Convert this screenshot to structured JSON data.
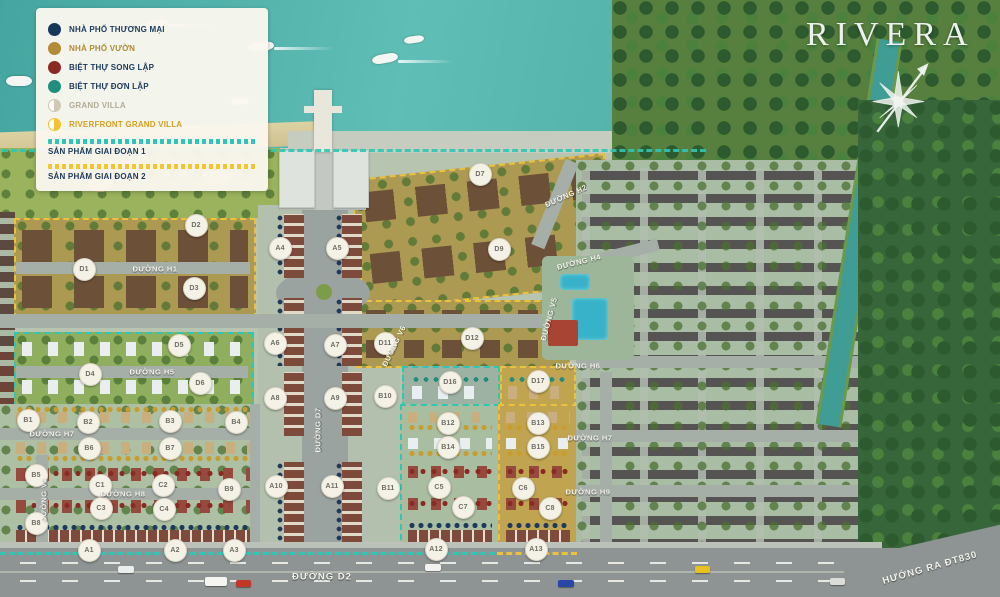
{
  "title": "RIVERA",
  "legend": {
    "items": [
      {
        "label": "NHÀ PHỐ THƯƠNG MẠI",
        "color": "#17375c",
        "text_color": "#1b3a5c",
        "style": "solid"
      },
      {
        "label": "NHÀ PHỐ VƯỜN",
        "color": "#b38a35",
        "text_color": "#b38a35",
        "style": "solid"
      },
      {
        "label": "BIỆT THỰ SONG LẬP",
        "color": "#8a2a22",
        "text_color": "#1b3a5c",
        "style": "solid"
      },
      {
        "label": "BIỆT THỰ ĐƠN LẬP",
        "color": "#1f8e7e",
        "text_color": "#1b3a5c",
        "style": "solid"
      },
      {
        "label": "GRAND VILLA",
        "color": "#cfc8b2",
        "text_color": "#b3ac97",
        "style": "half"
      },
      {
        "label": "RIVERFRONT GRAND VILLA",
        "color": "#f2c230",
        "text_color": "#d4a020",
        "style": "half"
      }
    ],
    "phases": [
      {
        "label": "SẢN PHẨM GIAI ĐOẠN 1",
        "color": "#2fc7b4"
      },
      {
        "label": "SẢN PHẨM GIAI ĐOẠN 2",
        "color": "#f2c431"
      }
    ]
  },
  "map": {
    "blocks": [
      {
        "label": "D1",
        "x": 83,
        "y": 268
      },
      {
        "label": "D2",
        "x": 195,
        "y": 224
      },
      {
        "label": "D3",
        "x": 193,
        "y": 287
      },
      {
        "label": "D4",
        "x": 89,
        "y": 373
      },
      {
        "label": "D5",
        "x": 178,
        "y": 344
      },
      {
        "label": "D6",
        "x": 199,
        "y": 382
      },
      {
        "label": "D7",
        "x": 479,
        "y": 173
      },
      {
        "label": "D9",
        "x": 498,
        "y": 248
      },
      {
        "label": "D11",
        "x": 384,
        "y": 342
      },
      {
        "label": "D12",
        "x": 471,
        "y": 337
      },
      {
        "label": "D16",
        "x": 449,
        "y": 381
      },
      {
        "label": "D17",
        "x": 537,
        "y": 380
      },
      {
        "label": "A1",
        "x": 88,
        "y": 549
      },
      {
        "label": "A2",
        "x": 174,
        "y": 549
      },
      {
        "label": "A3",
        "x": 233,
        "y": 549
      },
      {
        "label": "A4",
        "x": 279,
        "y": 247
      },
      {
        "label": "A5",
        "x": 336,
        "y": 247
      },
      {
        "label": "A6",
        "x": 274,
        "y": 342
      },
      {
        "label": "A7",
        "x": 334,
        "y": 344
      },
      {
        "label": "A8",
        "x": 274,
        "y": 397
      },
      {
        "label": "A9",
        "x": 334,
        "y": 397
      },
      {
        "label": "A10",
        "x": 275,
        "y": 485
      },
      {
        "label": "A11",
        "x": 331,
        "y": 485
      },
      {
        "label": "A12",
        "x": 435,
        "y": 548
      },
      {
        "label": "A13",
        "x": 535,
        "y": 548
      },
      {
        "label": "B1",
        "x": 27,
        "y": 419
      },
      {
        "label": "B2",
        "x": 87,
        "y": 421
      },
      {
        "label": "B3",
        "x": 169,
        "y": 420
      },
      {
        "label": "B4",
        "x": 235,
        "y": 421
      },
      {
        "label": "B5",
        "x": 35,
        "y": 474
      },
      {
        "label": "B6",
        "x": 88,
        "y": 447
      },
      {
        "label": "B7",
        "x": 169,
        "y": 447
      },
      {
        "label": "B8",
        "x": 35,
        "y": 522
      },
      {
        "label": "B9",
        "x": 228,
        "y": 488
      },
      {
        "label": "B10",
        "x": 384,
        "y": 395
      },
      {
        "label": "B11",
        "x": 387,
        "y": 487
      },
      {
        "label": "B12",
        "x": 447,
        "y": 422
      },
      {
        "label": "B13",
        "x": 537,
        "y": 422
      },
      {
        "label": "B14",
        "x": 447,
        "y": 446
      },
      {
        "label": "B15",
        "x": 537,
        "y": 446
      },
      {
        "label": "C1",
        "x": 99,
        "y": 484
      },
      {
        "label": "C2",
        "x": 162,
        "y": 484
      },
      {
        "label": "C3",
        "x": 100,
        "y": 507
      },
      {
        "label": "C4",
        "x": 163,
        "y": 508
      },
      {
        "label": "C5",
        "x": 438,
        "y": 486
      },
      {
        "label": "C6",
        "x": 522,
        "y": 487
      },
      {
        "label": "C7",
        "x": 462,
        "y": 506
      },
      {
        "label": "C8",
        "x": 549,
        "y": 507
      }
    ],
    "roads": [
      {
        "name": "ĐƯỜNG H1",
        "x": 155,
        "y": 269,
        "angle": 0
      },
      {
        "name": "ĐƯỜNG H5",
        "x": 152,
        "y": 372,
        "angle": 0
      },
      {
        "name": "ĐƯỜNG H7",
        "x": 52,
        "y": 434,
        "angle": 0
      },
      {
        "name": "ĐƯỜNG H8",
        "x": 123,
        "y": 494,
        "angle": 0
      },
      {
        "name": "ĐƯỜNG V1",
        "x": 44,
        "y": 500,
        "angle": -90
      },
      {
        "name": "ĐƯỜNG D7",
        "x": 318,
        "y": 430,
        "angle": -90
      },
      {
        "name": "ĐƯỜNG D2",
        "x": 322,
        "y": 577,
        "angle": 0,
        "big": true
      },
      {
        "name": "ĐƯỜNG H2",
        "x": 566,
        "y": 196,
        "angle": -24
      },
      {
        "name": "ĐƯỜNG H4",
        "x": 579,
        "y": 262,
        "angle": -14
      },
      {
        "name": "ĐƯỜNG V5",
        "x": 549,
        "y": 319,
        "angle": -75
      },
      {
        "name": "ĐƯỜNG V6",
        "x": 394,
        "y": 346,
        "angle": -64
      },
      {
        "name": "ĐƯỜNG H6",
        "x": 578,
        "y": 366,
        "angle": 0
      },
      {
        "name": "ĐƯỜNG H7",
        "x": 590,
        "y": 438,
        "angle": 0
      },
      {
        "name": "ĐƯỜNG H9",
        "x": 588,
        "y": 492,
        "angle": 0
      },
      {
        "name": "HƯỚNG RA ĐT830",
        "x": 930,
        "y": 568,
        "angle": -16,
        "big": true
      }
    ]
  }
}
